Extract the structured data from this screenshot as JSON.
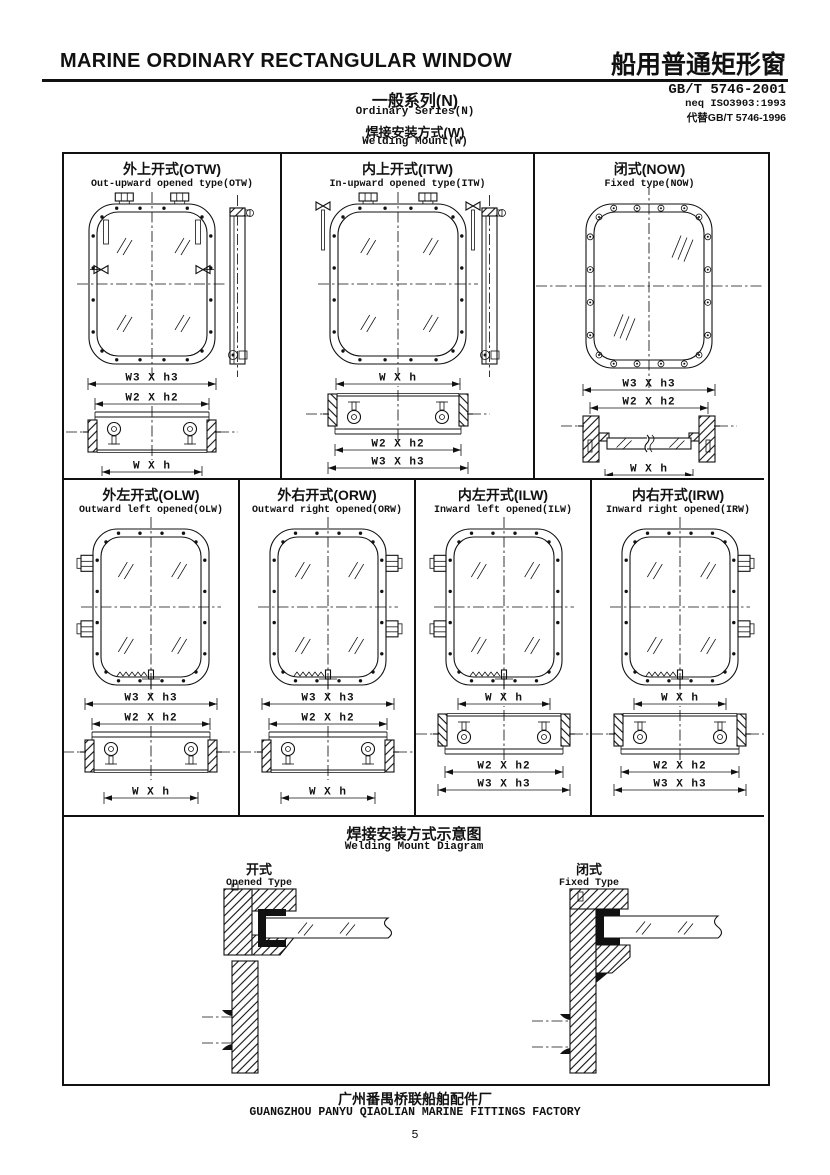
{
  "header": {
    "title_en": "MARINE ORDINARY RECTANGULAR WINDOW",
    "title_zh": "船用普通矩形窗",
    "series_zh": "一般系列(N)",
    "series_en": "Ordinary Series(N)",
    "mount_zh": "焊接安装方式(W)",
    "mount_en": "Welding Mount(W)",
    "standard": "GB/T 5746-2001",
    "standard_neq": "neq ISO3903:1993",
    "standard_replaces": "代替GB/T 5746-1996"
  },
  "panels": [
    {
      "id": "otw",
      "title_zh": "外上开式(OTW)",
      "title_en": "Out-upward opened type(OTW)",
      "dims_top": [
        "W3 X h3",
        "W2 X h2"
      ],
      "dims_bottom": [
        "W X h"
      ]
    },
    {
      "id": "itw",
      "title_zh": "内上开式(ITW)",
      "title_en": "In-upward opened type(ITW)",
      "dims_top": [
        "W X h"
      ],
      "dims_bottom": [
        "W2 X h2",
        "W3 X h3"
      ]
    },
    {
      "id": "now",
      "title_zh": "闭式(NOW)",
      "title_en": "Fixed type(NOW)",
      "dims_top": [
        "W3 X h3",
        "W2 X h2"
      ],
      "dims_bottom": [
        "W X h"
      ]
    },
    {
      "id": "olw",
      "title_zh": "外左开式(OLW)",
      "title_en": "Outward left opened(OLW)",
      "dims_top": [
        "W3 X h3",
        "W2 X h2"
      ],
      "dims_bottom": [
        "W X h"
      ]
    },
    {
      "id": "orw",
      "title_zh": "外右开式(ORW)",
      "title_en": "Outward right opened(ORW)",
      "dims_top": [
        "W3 X h3",
        "W2 X h2"
      ],
      "dims_bottom": [
        "W X h"
      ]
    },
    {
      "id": "ilw",
      "title_zh": "内左开式(ILW)",
      "title_en": "Inward left opened(ILW)",
      "dims_top": [
        "W X h"
      ],
      "dims_bottom": [
        "W2 X h2",
        "W3 X h3"
      ]
    },
    {
      "id": "irw",
      "title_zh": "内右开式(IRW)",
      "title_en": "Inward right opened(IRW)",
      "dims_top": [
        "W X h"
      ],
      "dims_bottom": [
        "W2 X h2",
        "W3 X h3"
      ]
    }
  ],
  "welding": {
    "title_zh": "焊接安装方式示意图",
    "title_en": "Welding Mount Diagram",
    "opened_zh": "开式",
    "opened_en": "Opened Type",
    "fixed_zh": "闭式",
    "fixed_en": "Fixed Type"
  },
  "footer": {
    "factory_zh": "广州番禺桥联船舶配件厂",
    "factory_en": "GUANGZHOU PANYU QIAOLIAN MARINE FITTINGS FACTORY",
    "page": "5"
  },
  "colors": {
    "ink": "#111111",
    "paper": "#ffffff"
  }
}
